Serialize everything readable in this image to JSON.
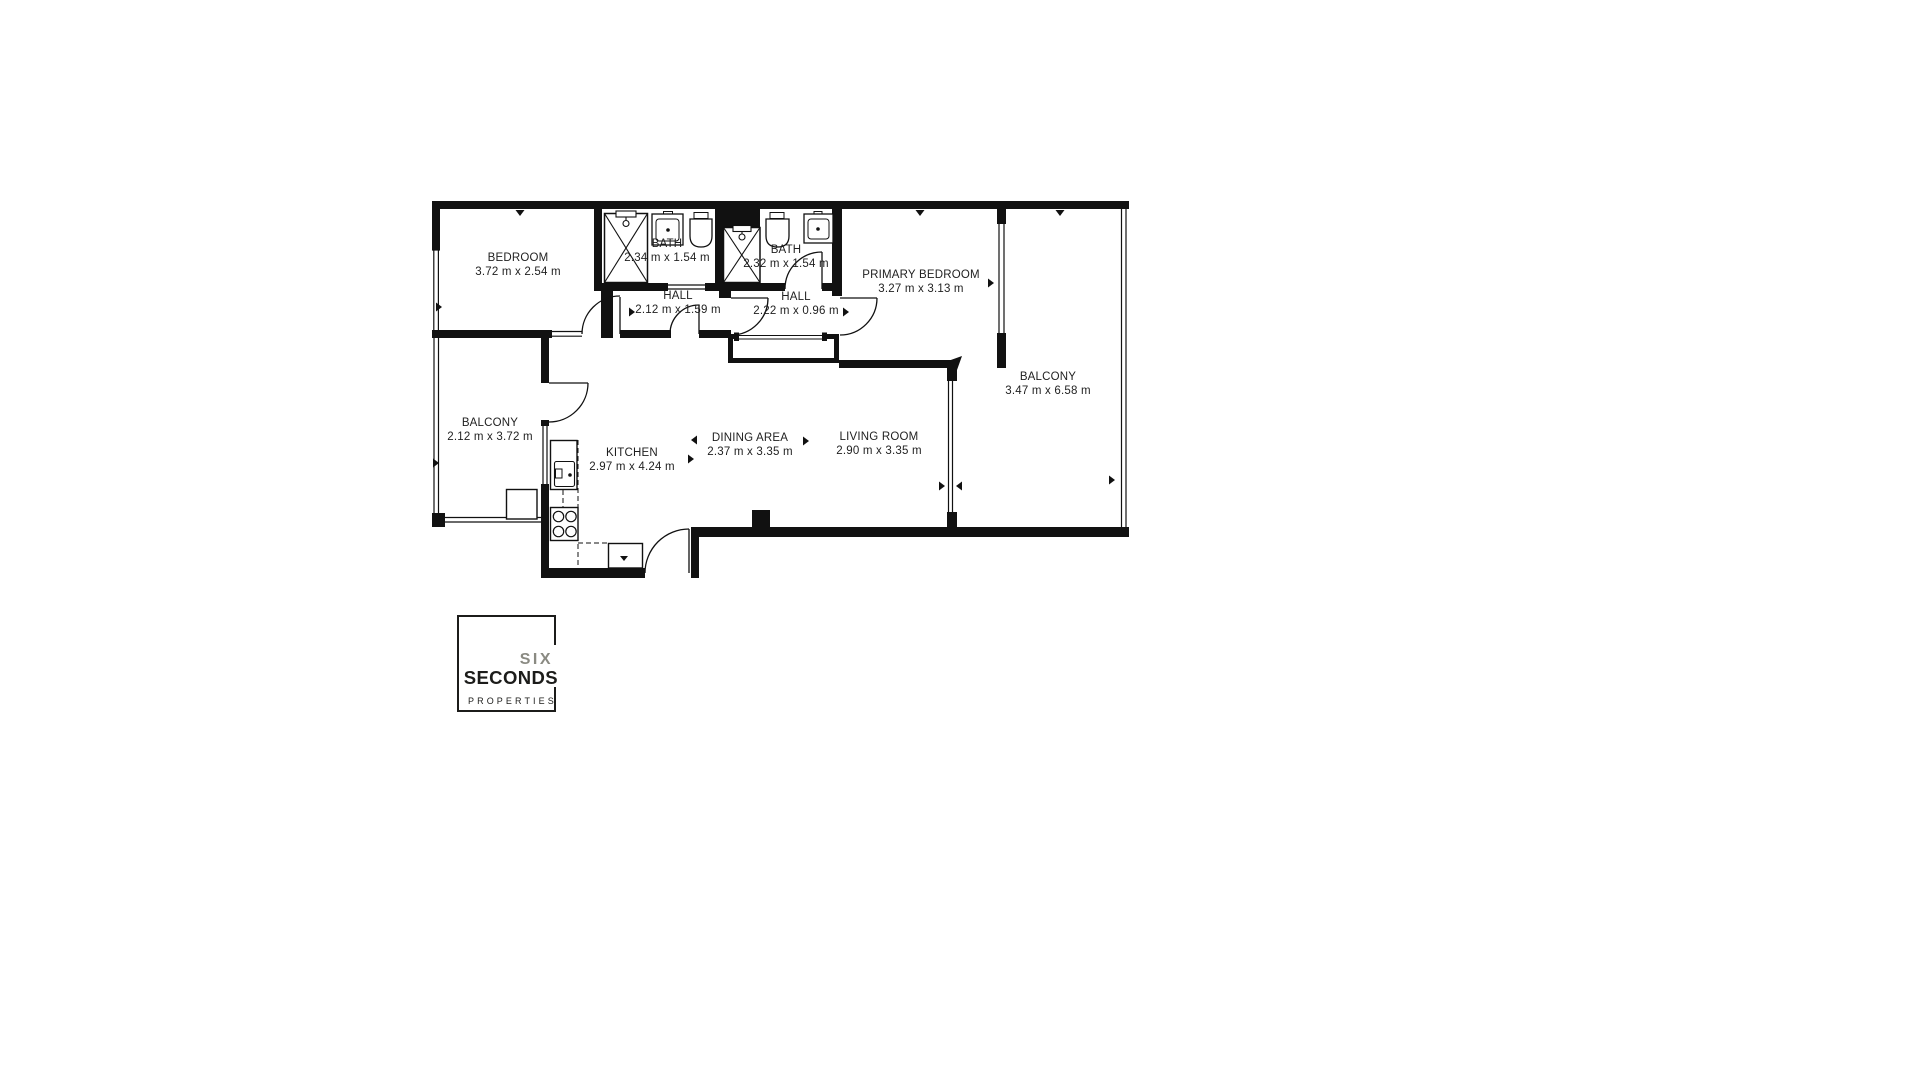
{
  "branding": {
    "six": "SIX",
    "seconds": "SECONDS",
    "properties": "PROPERTIES"
  },
  "rooms": [
    {
      "name": "BEDROOM",
      "dims": "3.72 m x 2.54 m"
    },
    {
      "name": "BATH",
      "dims": "2.34 m x 1.54 m"
    },
    {
      "name": "BATH",
      "dims": "2.32 m x 1.54 m"
    },
    {
      "name": "PRIMARY BEDROOM",
      "dims": "3.27 m x 3.13 m"
    },
    {
      "name": "HALL",
      "dims": "2.12 m x 1.59 m"
    },
    {
      "name": "HALL",
      "dims": "2.22 m x 0.96 m"
    },
    {
      "name": "BALCONY",
      "dims": "3.47 m x 6.58 m"
    },
    {
      "name": "BALCONY",
      "dims": "2.12 m x 3.72 m"
    },
    {
      "name": "KITCHEN",
      "dims": "2.97 m x 4.24 m"
    },
    {
      "name": "DINING AREA",
      "dims": "2.37 m x 3.35 m"
    },
    {
      "name": "LIVING ROOM",
      "dims": "2.90 m x 3.35 m"
    }
  ],
  "colors": {
    "wall": "#111111",
    "logo_gray": "#8a8a82",
    "text": "#1f1f1f",
    "background": "#ffffff"
  }
}
